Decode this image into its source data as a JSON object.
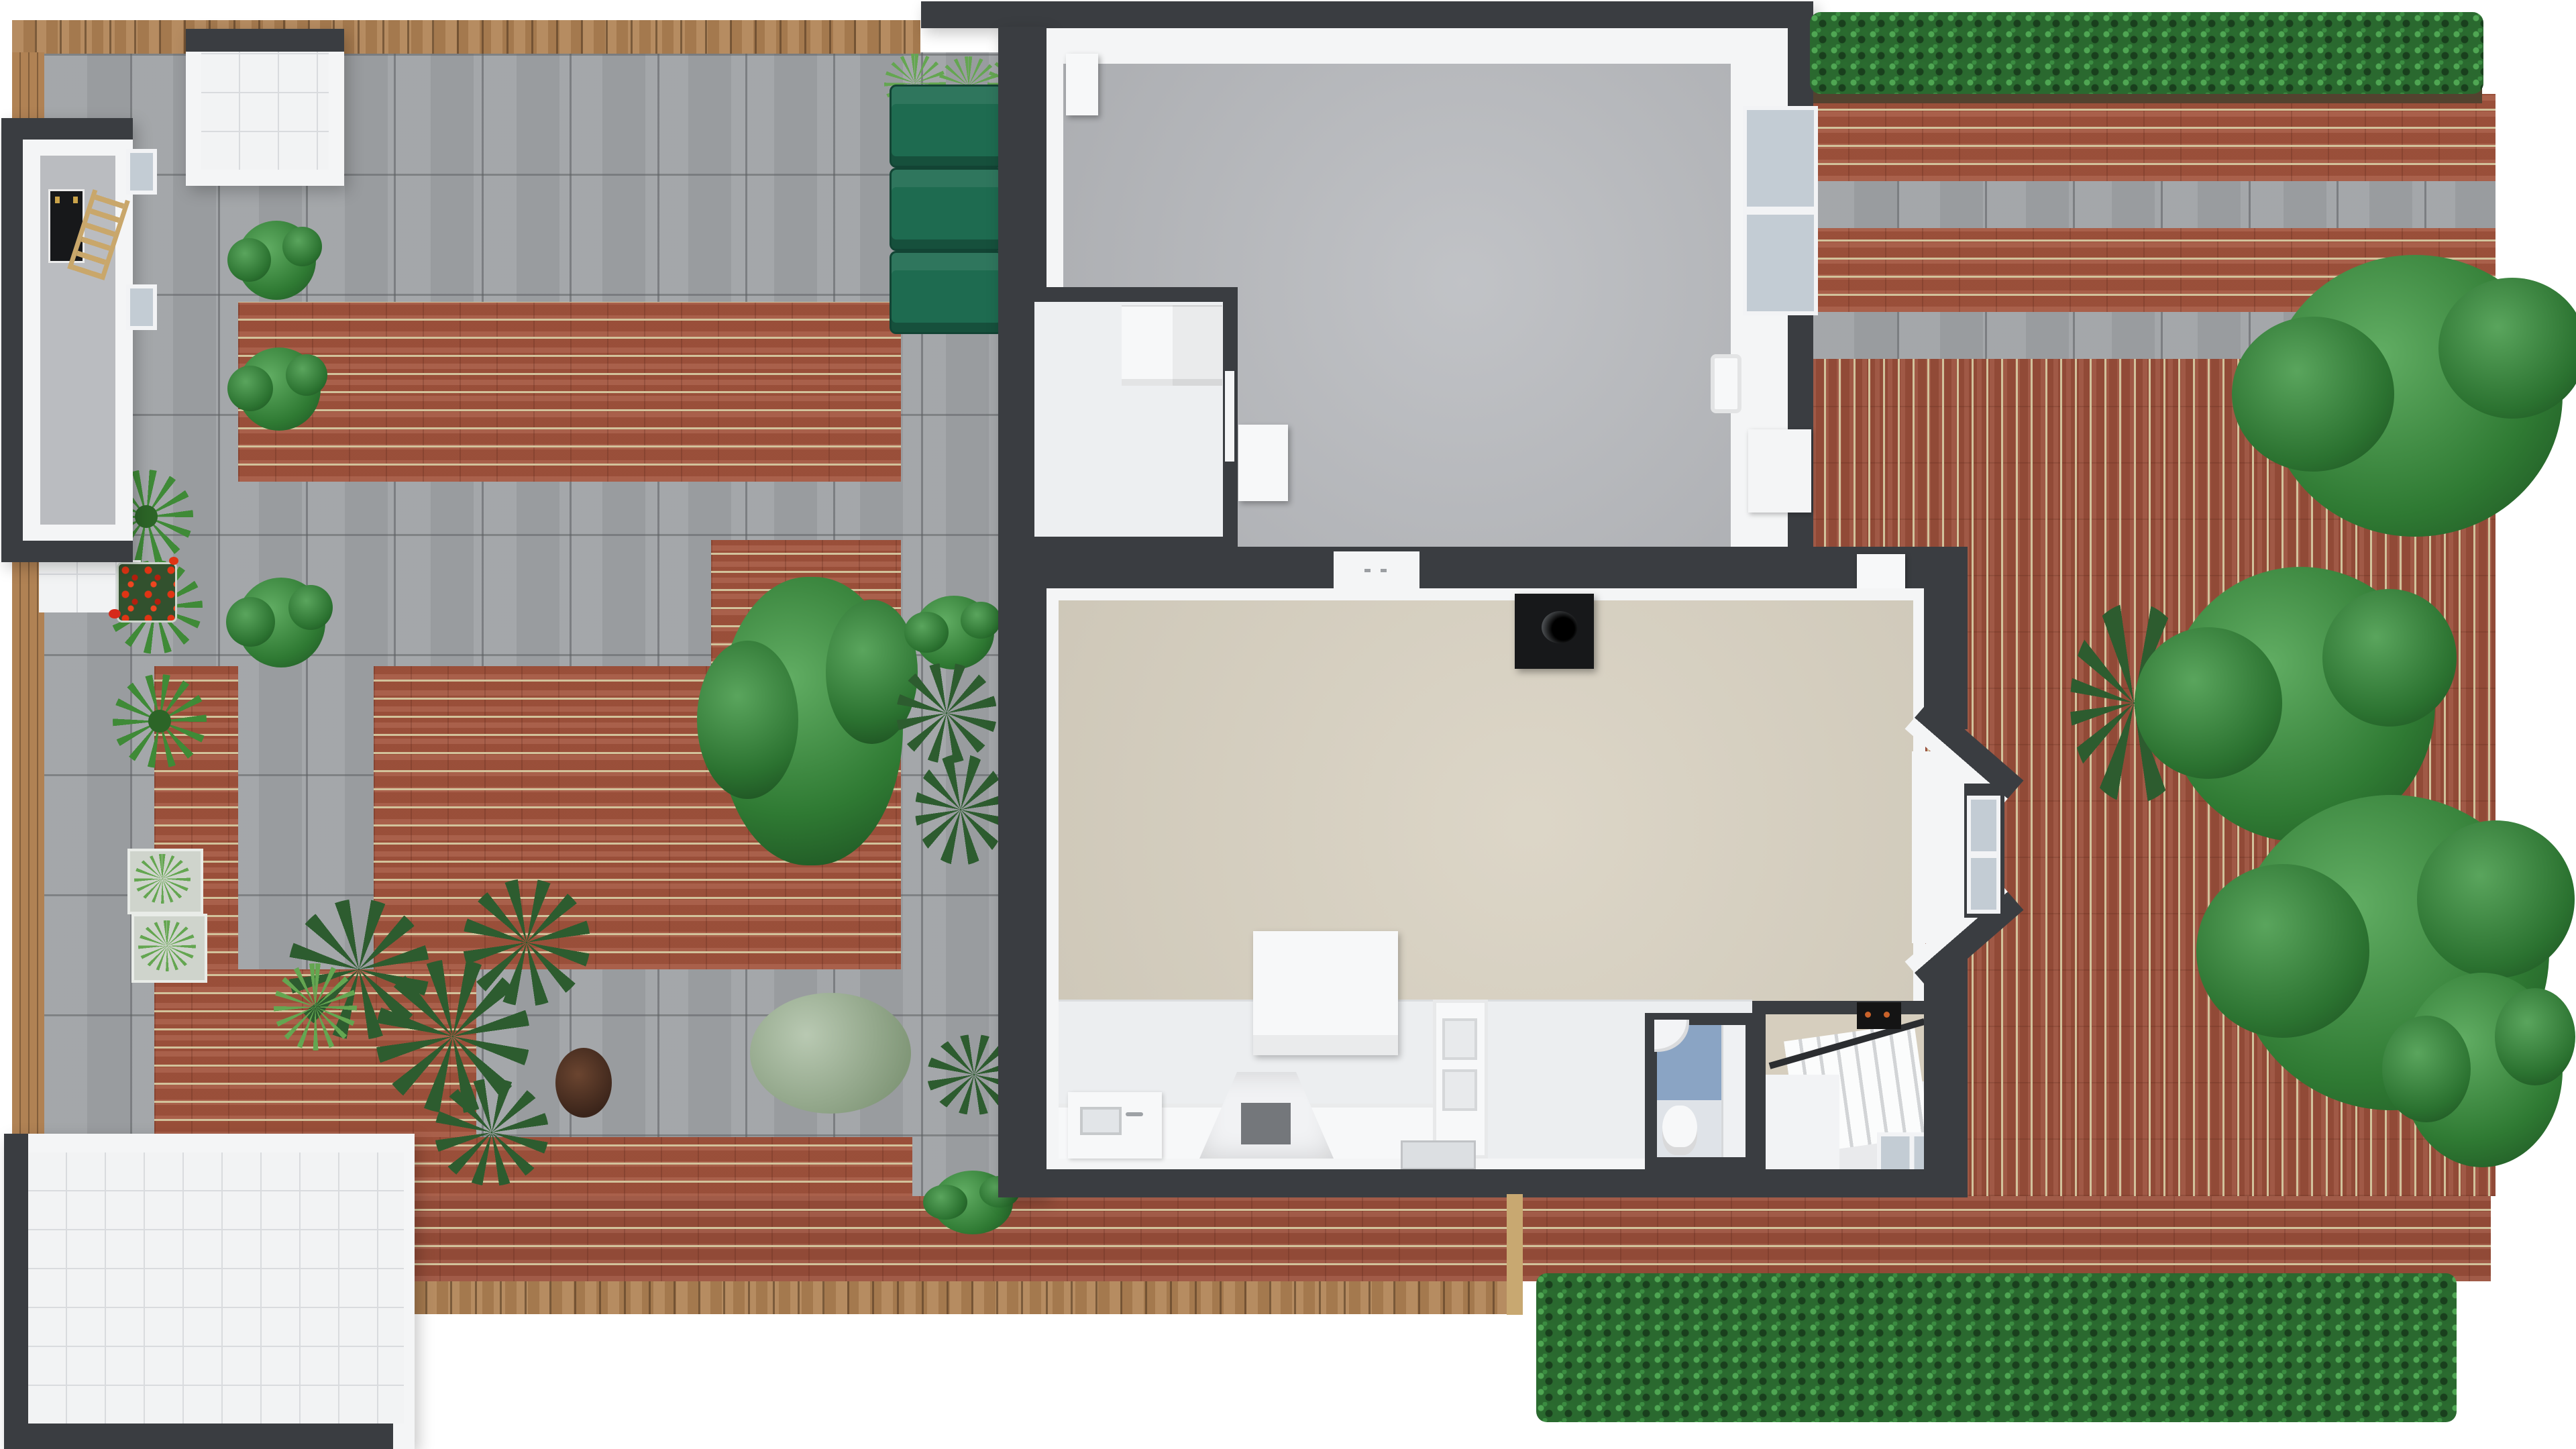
{
  "scene": {
    "kind": "3d-floor-plan-render",
    "view": "top-down",
    "background": "#ffffff",
    "floors_visible": 1
  },
  "palette": {
    "wall_dark": "#3a3d41",
    "wall_inner": "#f4f5f6",
    "garage_floor": "#babcc0",
    "living_floor": "#d9d2c2",
    "utility_floor": "#edeff1",
    "kitchen_floor": "#eceef0",
    "hall_floor": "#eceef0",
    "stair_wall": "#d6cebe",
    "stair_floor": "#e9eaec",
    "bath_wall": "#8aa4c4",
    "bath_floor": "#dfe3e8",
    "paver_grey": "#9fa2a5",
    "brick_red": "#a3543d",
    "brick_red_dark": "#9a4f3a",
    "brick_mortar": "#d2c29b",
    "deck_wood": "#b08254",
    "tile_white": "#f2f3f4",
    "hedge_green": "#2a692f",
    "tree_green": "#3e8c40",
    "shrub_dark": "#2d5c2f",
    "sage_green": "#93ac89",
    "bin_green": "#1e6b50",
    "flower_red": "#d62a1a",
    "planter_green": "#32512e",
    "soil_brown": "#53422f",
    "ladder_wood": "#c9a76b",
    "gate_wood": "#c8a871",
    "stove_black": "#17181a",
    "oven_black": "#141414",
    "oven_knob_orange": "#c9622a",
    "glass_grey": "#c3ccd4",
    "appliance_white": "#f7f8f9"
  },
  "house": {
    "rooms": [
      {
        "name": "garage",
        "floor": "grey"
      },
      {
        "name": "utility-room",
        "floor": "white"
      },
      {
        "name": "living-room",
        "floor": "beige"
      },
      {
        "name": "kitchen",
        "floor": "white"
      },
      {
        "name": "hallway",
        "floor": "white"
      },
      {
        "name": "bathroom",
        "floor": "blue"
      },
      {
        "name": "stair-room",
        "floor": "white"
      }
    ],
    "objects": [
      {
        "name": "water-heater",
        "room": "garage"
      },
      {
        "name": "wall-sink",
        "room": "garage"
      },
      {
        "name": "freezer",
        "room": "garage"
      },
      {
        "name": "washing-machine",
        "room": "utility-room"
      },
      {
        "name": "sliding-door",
        "room": "utility-room"
      },
      {
        "name": "wood-stove-with-flue",
        "room": "living-room"
      },
      {
        "name": "bay-window",
        "room": "living-room"
      },
      {
        "name": "kitchen-island",
        "room": "kitchen"
      },
      {
        "name": "sink-counter",
        "room": "kitchen"
      },
      {
        "name": "extractor-hood",
        "room": "kitchen"
      },
      {
        "name": "tall-cabinet",
        "room": "kitchen"
      },
      {
        "name": "toilet",
        "room": "bathroom"
      },
      {
        "name": "wash-basin",
        "room": "bathroom"
      },
      {
        "name": "staircase",
        "room": "stair-room"
      },
      {
        "name": "built-in-oven",
        "room": "stair-room"
      },
      {
        "name": "window",
        "room": "stair-room"
      }
    ]
  },
  "garden": {
    "structures": [
      {
        "name": "shed",
        "contents": [
          "black-mat",
          "wooden-ladder"
        ]
      },
      {
        "name": "open-canopy-store",
        "floor": "white-tile"
      },
      {
        "name": "patio-structure",
        "floor": "white-tile"
      }
    ],
    "bins": {
      "count": 3,
      "color": "green"
    },
    "planting": {
      "patio_trees": 4,
      "right_edge_trees": 4,
      "spiky_plants": 3,
      "palm_cluster": 4,
      "red_flower_planter": 1,
      "hedges": [
        "top-right",
        "bottom-right"
      ],
      "wall_bushes": 5
    },
    "materials": [
      "grey-pavers",
      "red-brick-running-bond",
      "red-brick-stack-bond",
      "timber-deck",
      "white-tiles"
    ]
  }
}
